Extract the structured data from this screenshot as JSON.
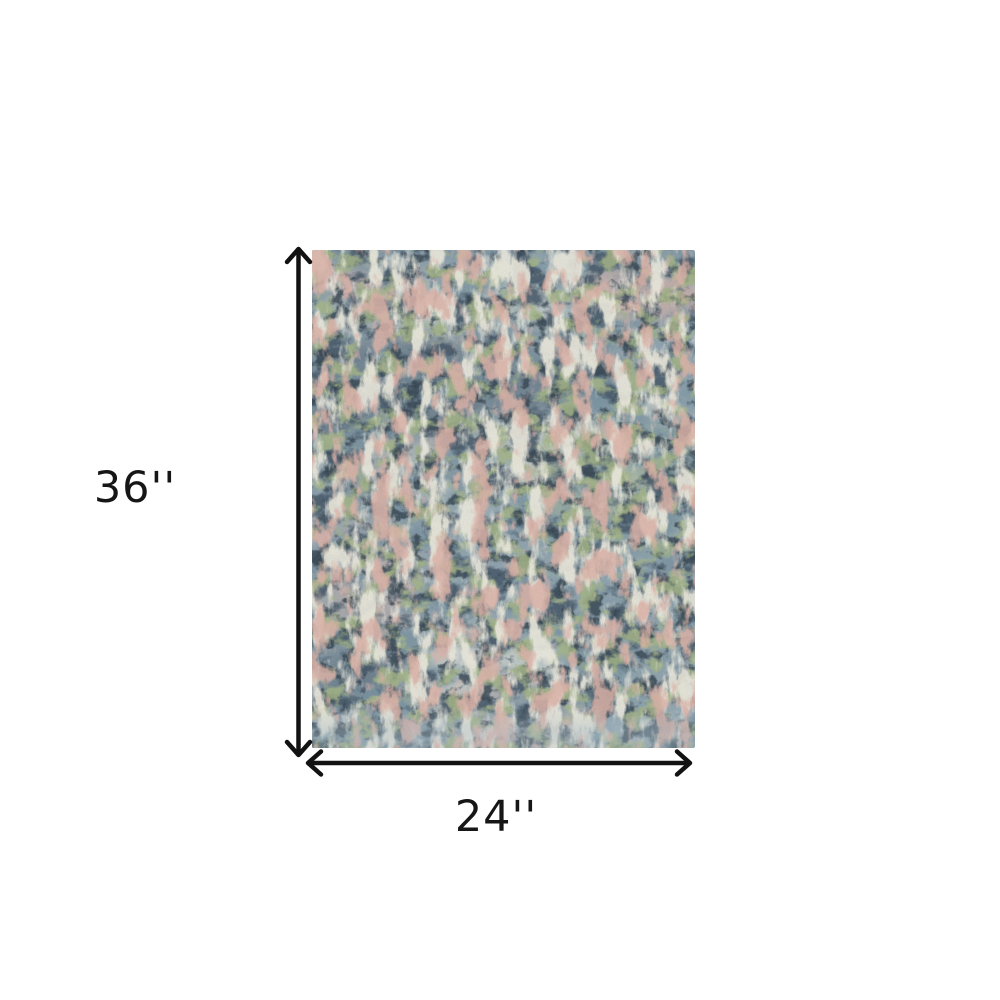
{
  "figure": {
    "kind": "product-dimension-diagram",
    "subject": "abstract-pattern area rug (top view)",
    "height_label": "36''",
    "width_label": "24''"
  },
  "colors": {
    "background": "#ffffff",
    "dimension_arrow": "#121212",
    "label_text": "#161616",
    "rug_base_slate": "#8ca1ac",
    "rug_slate_dark": "#3e5060",
    "rug_navy_deep": "#2c3a46",
    "rug_sage_green": "#a3b483",
    "rug_cream": "#efecdf",
    "rug_blush_pink": "#dfb2a6",
    "rug_bottom_light": "#9fb3bd"
  }
}
